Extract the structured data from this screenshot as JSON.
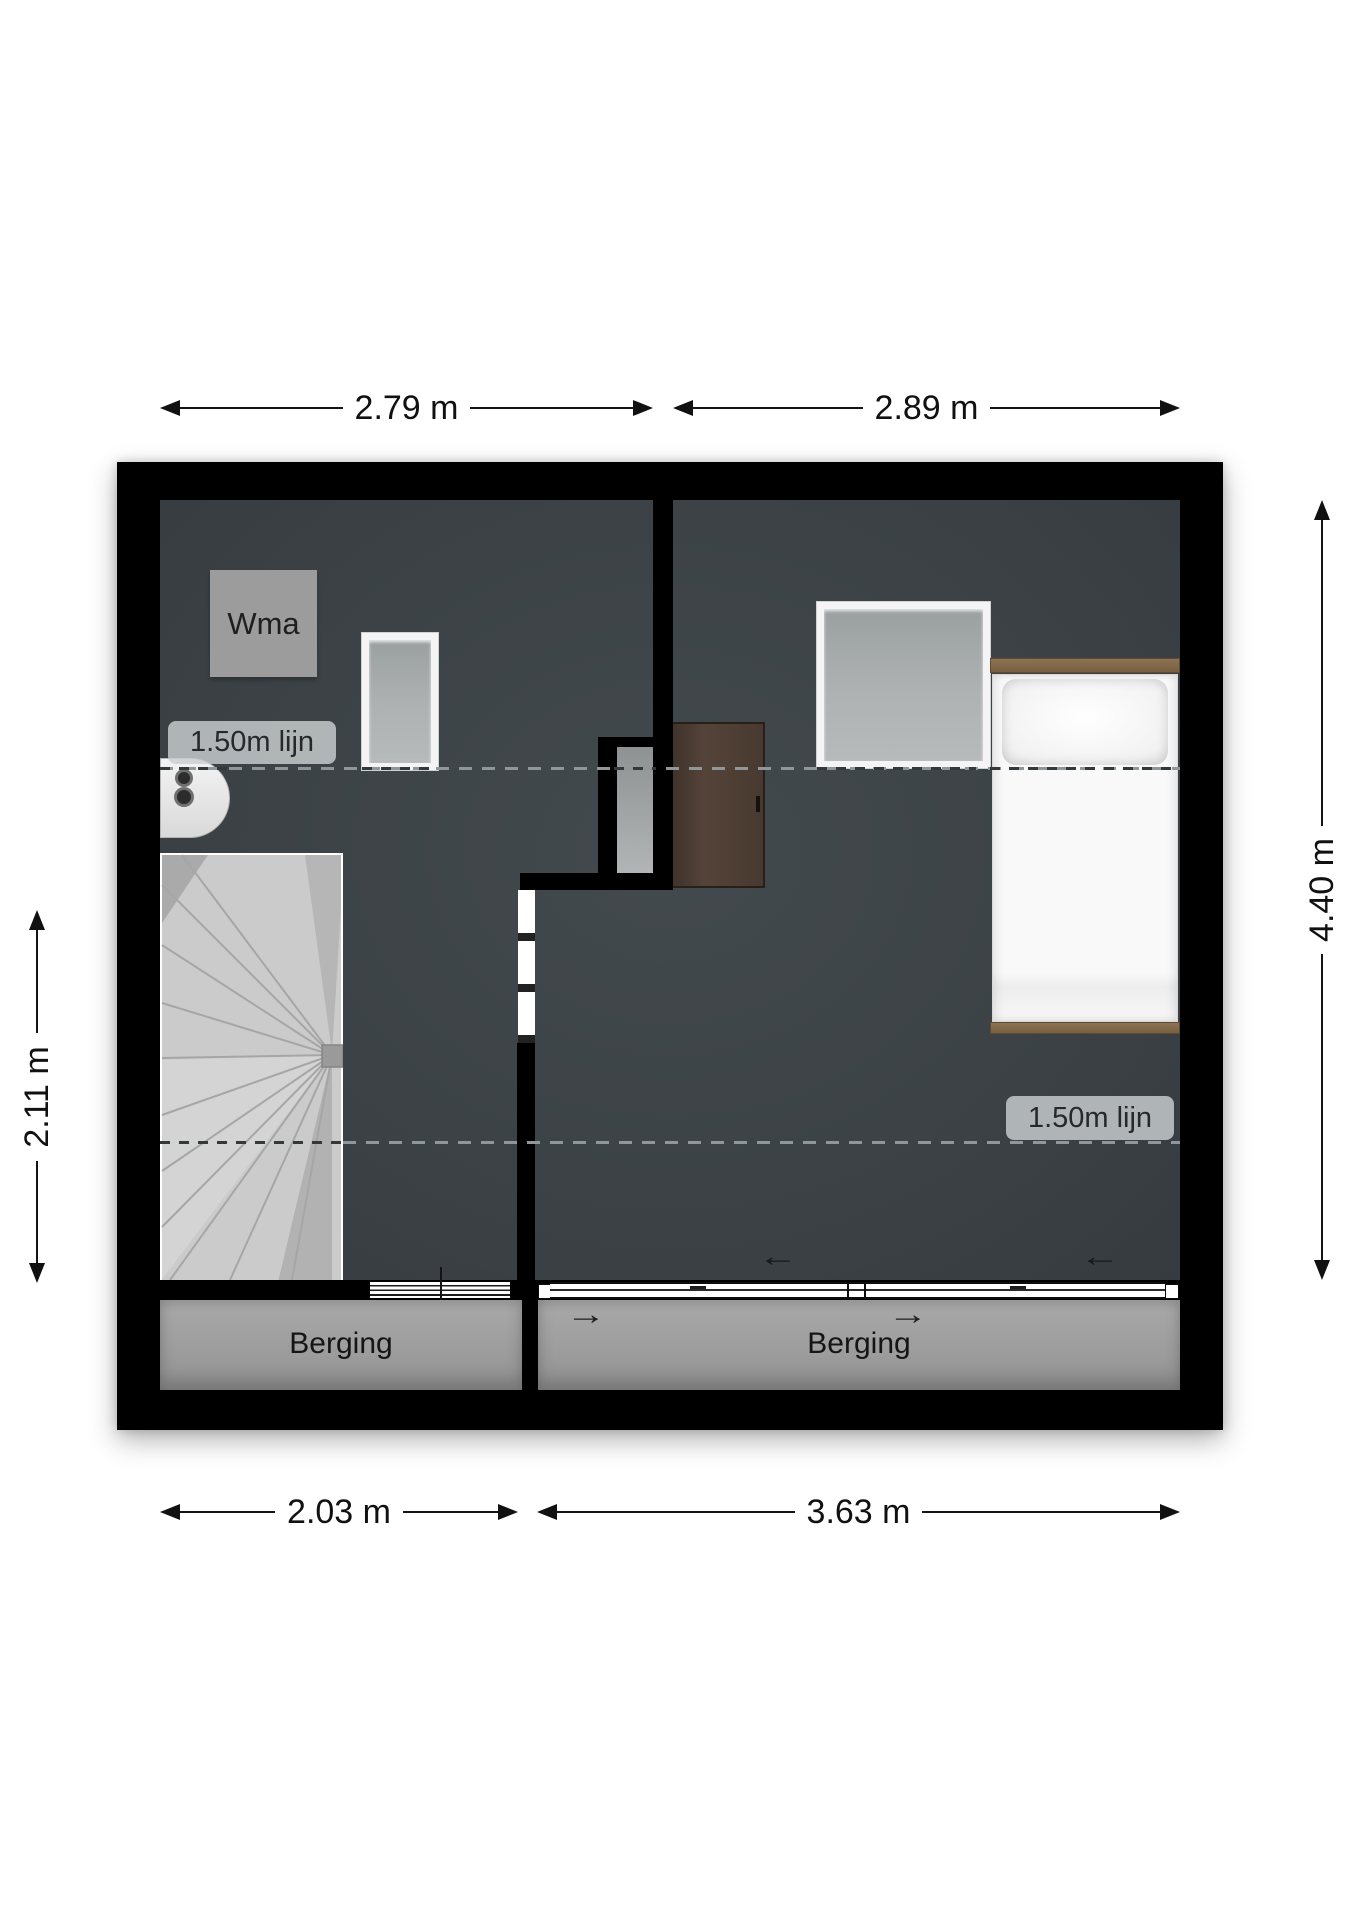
{
  "plan": {
    "type": "floorplan",
    "floor_name_hint": "attic storey with two storage zones",
    "rooms": [
      {
        "id": "left_room",
        "features": [
          "washing machine position",
          "skylight",
          "boiler",
          "winder staircase"
        ]
      },
      {
        "id": "right_room",
        "features": [
          "skylight",
          "single bed",
          "wardrobe"
        ]
      },
      {
        "id": "storage_left",
        "label": "Berging"
      },
      {
        "id": "storage_right",
        "label": "Berging"
      }
    ]
  },
  "labels": {
    "wma": "Wma",
    "berging_left": "Berging",
    "berging_right": "Berging",
    "height_line_left": "1.50m lijn",
    "height_line_right": "1.50m lijn"
  },
  "dimensions": {
    "top_left": "2.79 m",
    "top_right": "2.89 m",
    "bottom_left": "2.03 m",
    "bottom_right": "3.63 m",
    "side_left": "2.11 m",
    "side_right": "4.40 m"
  },
  "arrows": {
    "slide_left_a": "←",
    "slide_left_b": "←",
    "slide_right_a": "→",
    "slide_right_b": "→"
  },
  "colors": {
    "wall": "#000000",
    "floor_dark": "#3d4347",
    "storage_gray": "#9c9c9c",
    "stairs_light": "#cbcbcb",
    "bed_wood": "#8d7254",
    "cabinet_brown": "#483a30",
    "dash_light": "#8f979b",
    "dash_dark": "#33383b",
    "label_chip": "rgba(201,206,208,0.82)"
  }
}
